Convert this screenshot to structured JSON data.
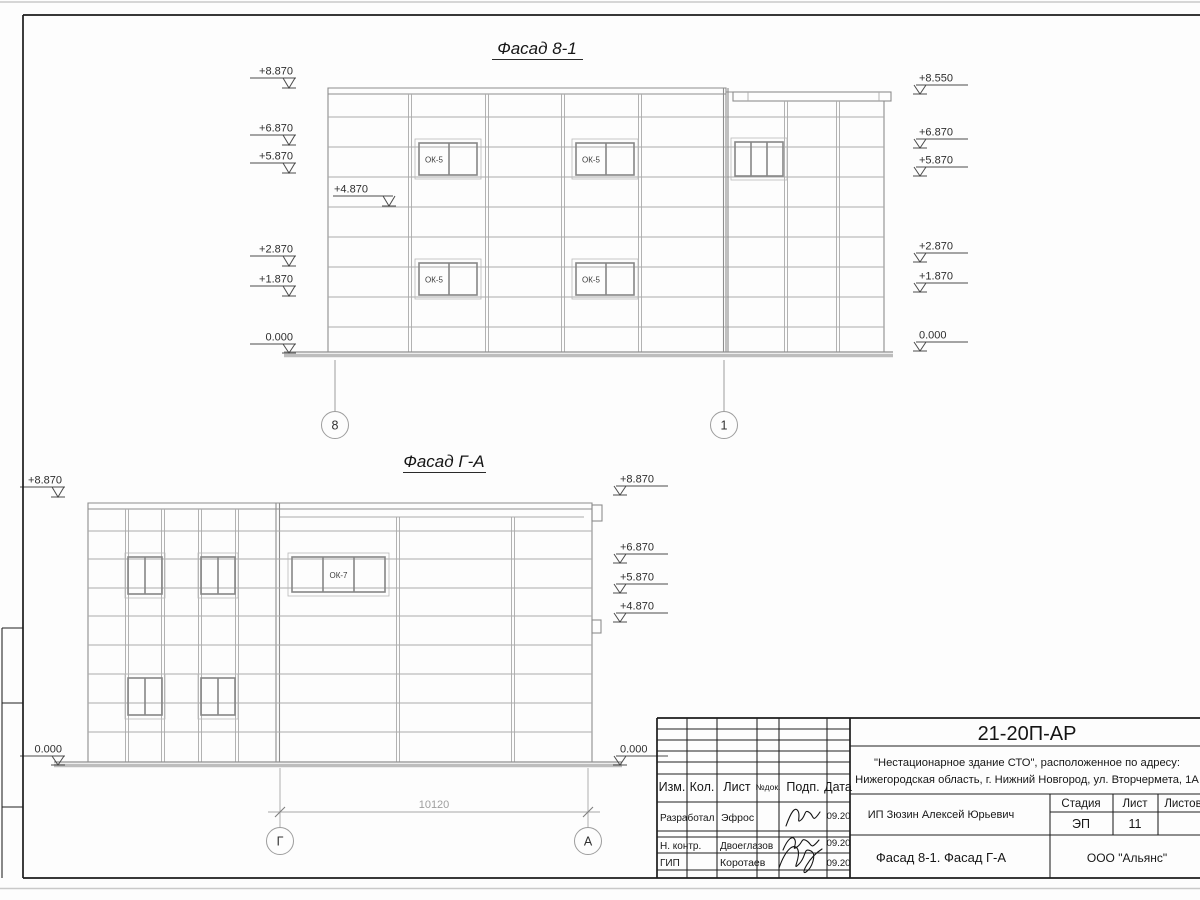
{
  "drawing": {
    "facade1": {
      "title": "Фасад 8-1",
      "marks_left": [
        "+8.870",
        "+6.870",
        "+5.870",
        "+2.870",
        "+1.870",
        "0.000"
      ],
      "mark_inner": "+4.870",
      "marks_right": [
        "+8.550",
        "+6.870",
        "+5.870",
        "+2.870",
        "+1.870",
        "0.000"
      ],
      "window_label": "ОК-5",
      "axis_left": "8",
      "axis_right": "1"
    },
    "facade2": {
      "title": "Фасад Г-А",
      "marks_left": [
        "+8.870",
        "0.000"
      ],
      "marks_right": [
        "+8.870",
        "+6.870",
        "+5.870",
        "+4.870",
        "0.000"
      ],
      "window_label": "ОК-7",
      "axis_left": "Г",
      "axis_right": "А",
      "dimension": "10120"
    }
  },
  "titleblock": {
    "doc_number": "21-20П-АР",
    "project_line1": "\"Нестационарное здание СТО\", расположенное по адресу:",
    "project_line2": "Нижегородская область, г. Нижний Новгород, ул. Вторчермета, 1А",
    "client": "ИП Зюзин Алексей Юрьевич",
    "sheet_title": "Фасад 8-1. Фасад Г-А",
    "company": "ООО \"Альянс\"",
    "stage_label": "Стадия",
    "sheet_label": "Лист",
    "sheets_label": "Листов",
    "stage_value": "ЭП",
    "sheet_value": "11",
    "columns": [
      "Изм.",
      "Кол.",
      "Лист",
      "№док.",
      "Подп.",
      "Дата"
    ],
    "rows": [
      {
        "role": "Разработал",
        "name": "Эфрос",
        "date": "09.20"
      },
      {
        "role": "Н. контр.",
        "name": "Двоеглазов",
        "date": "09.20"
      },
      {
        "role": "ГИП",
        "name": "Коротаев",
        "date": "09.20"
      }
    ]
  }
}
